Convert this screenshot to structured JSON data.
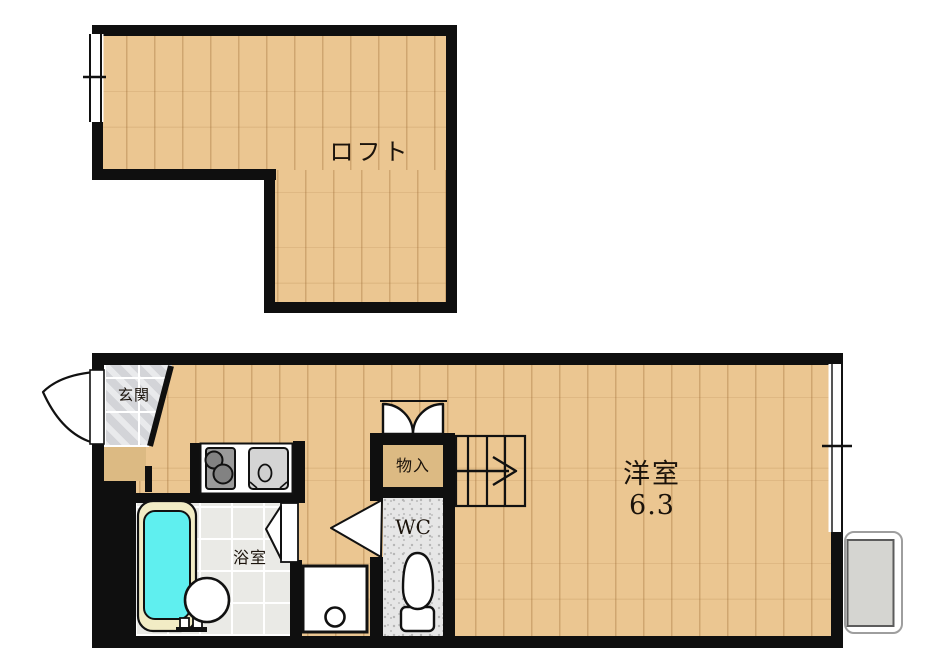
{
  "loft": {
    "label": "ロフト"
  },
  "floor": {
    "entrance_label": "玄関",
    "bath_label": "浴室",
    "wc_label": "WC",
    "storage_label": "物入",
    "room_label": "洋室",
    "room_size": "6.3"
  },
  "colors": {
    "wall": "#0f0f0f",
    "wood": "#ebc691",
    "step_wood": "#dcba83",
    "tile": "#d3d4d8",
    "bath_tile": "#eaeae6",
    "wc_floor": "#e6e6e6",
    "tub_rim": "#f2ecc5",
    "tub_water": "#5fefef",
    "fixture_grey": "#d5d5d1"
  }
}
